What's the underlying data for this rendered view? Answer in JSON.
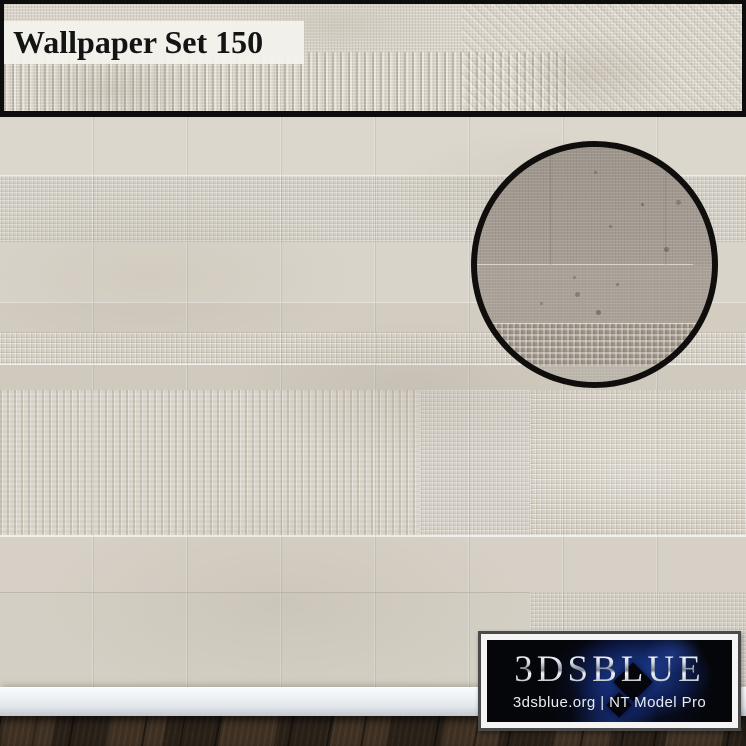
{
  "banner": {
    "title": "Wallpaper Set 150"
  },
  "logo": {
    "brand": "3DSBLUE",
    "tagline": "3dsblue.org | NT Model Pro"
  },
  "colors": {
    "banner_frame": "#0d0d0d",
    "banner_plaster": "#d8d3c9",
    "title_ink": "#141414",
    "title_label_bg": "#f2f0e9",
    "wall_base": "#d7d2c8",
    "wall_band_dark": "#ccc6ba",
    "inset_ring": "#0f0e0c",
    "inset_taupe": "#a69e95",
    "baseboard": "#eef2f6",
    "floor_wood": "#32281e",
    "logo_border": "#4a4a4a",
    "logo_frame": "#f4f4f4",
    "logo_bg": "#05060a",
    "logo_glow_blue": "#2d5fe1",
    "logo_silver": "#ccd2d9",
    "tagline_text": "#e9ecf0"
  }
}
